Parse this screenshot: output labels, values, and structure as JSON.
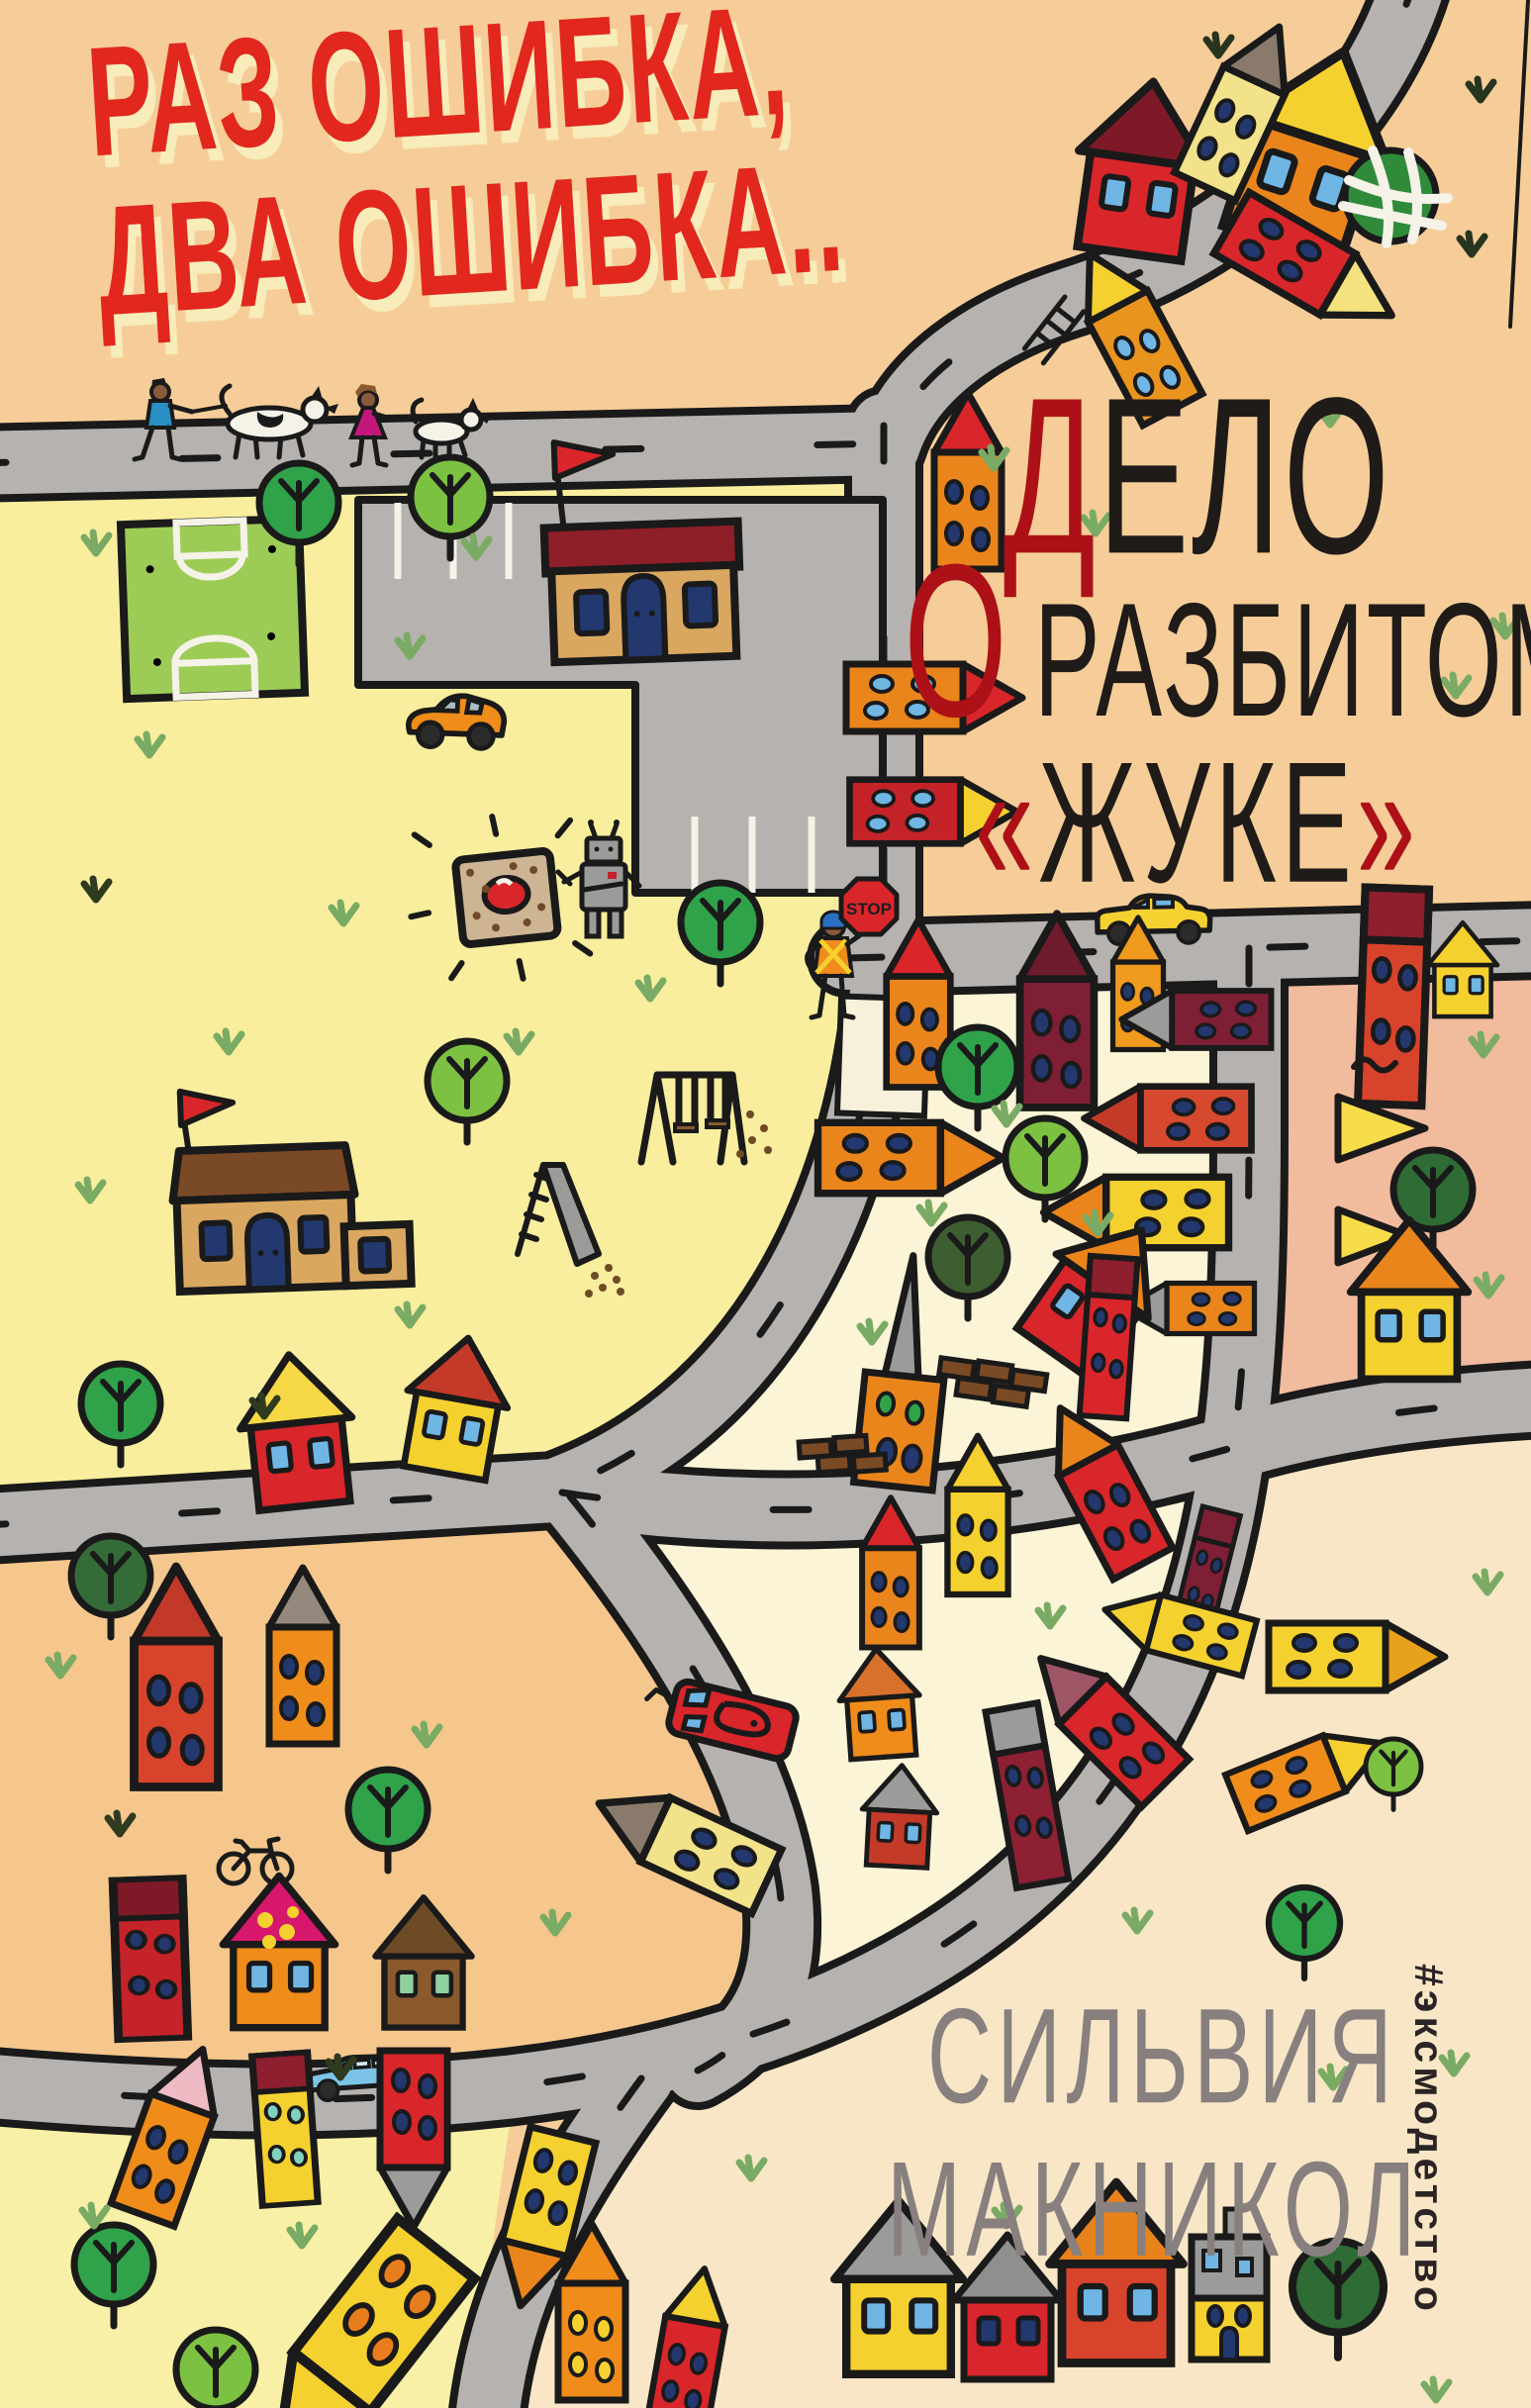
{
  "cover": {
    "series_title": {
      "line1": "РАЗ ОШИБКА,",
      "line2": "ДВА ОШИБКА.."
    },
    "title": {
      "line1_accent": "Д",
      "line1_rest": "ЕЛО",
      "line2_accent": "О",
      "line2_rest": "РАЗБИТОМ",
      "line3_open": "«",
      "line3_word": "ЖУКЕ",
      "line3_close": "»"
    },
    "author": {
      "first_name": "СИЛЬВИЯ",
      "last_name": "МАКНИКОЛ"
    },
    "publisher_hashtag": "#эксмодетство",
    "stop_sign_label": "STOP",
    "colors": {
      "title_red": "#e1271e",
      "title_shadow": "#f7ecba",
      "ink_black": "#1f1b18",
      "accent_dark_red": "#ad1117",
      "author_gray": "#87807f",
      "hashtag_black": "#2a2424",
      "outline_black": "#1a1a1a",
      "road_gray": "#b5b2af",
      "zone_peach": "#f6cd98",
      "zone_park_yellow": "#f8ee9d",
      "zone_cream": "#fbf4d6",
      "zone_pink": "#f1bb9e",
      "zone_orange": "#f5c78c",
      "zone_pale_yellow": "#f8f0a6",
      "zone_beige": "#f8e6c6",
      "house_red": "#d8262b",
      "house_dark_red": "#8e2033",
      "house_maroon": "#7e1f35",
      "house_orange": "#ea851c",
      "house_yellow": "#f5d12f",
      "house_pale_yellow": "#f2e28a",
      "house_tan": "#d9a75f",
      "house_brown": "#8a5a2e",
      "house_gray": "#9b9b99",
      "window_navy": "#22386e",
      "window_blue": "#6fb6e4",
      "tree_green": "#2fa24a",
      "tree_light_green": "#7cc142",
      "tree_dark_green": "#2e6b35",
      "grass_green": "#7aab64",
      "field_green": "#9ccc56",
      "sand_tan": "#cdb493",
      "brick_brown": "#7a4a24",
      "roof_magenta": "#d6176b",
      "car_orange": "#ef8c1a",
      "car_yellow": "#f5d12f",
      "car_blue": "#7cc3e8",
      "skin": "#8a5b3b",
      "cap_blue": "#2a6fc4",
      "dress_magenta": "#c4177c",
      "shirt_blue": "#2a8fc4"
    }
  }
}
